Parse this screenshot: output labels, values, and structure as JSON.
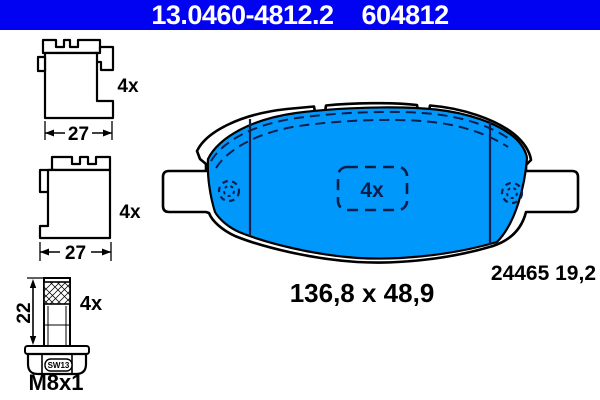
{
  "header": {
    "part_number": "13.0460-4812.2",
    "reference_number": "604812",
    "bg_color": "#0202F2",
    "text_color": "#FFFFFF"
  },
  "clips": [
    {
      "name": "retaining-clip-upper",
      "quantity": "4x",
      "width": "27"
    },
    {
      "name": "retaining-clip-lower",
      "quantity": "4x",
      "width": "27"
    }
  ],
  "bolt": {
    "name": "guide-bolt",
    "quantity": "4x",
    "length": "22",
    "thread": "M8x1",
    "wrench_size": "SW13"
  },
  "pad": {
    "name": "brake-pad",
    "quantity": "4x",
    "size": "136,8 x 48,9",
    "wva_number": "24465 19,2",
    "fill_color": "#0099FB",
    "marking_color": "#0B1E4B"
  }
}
